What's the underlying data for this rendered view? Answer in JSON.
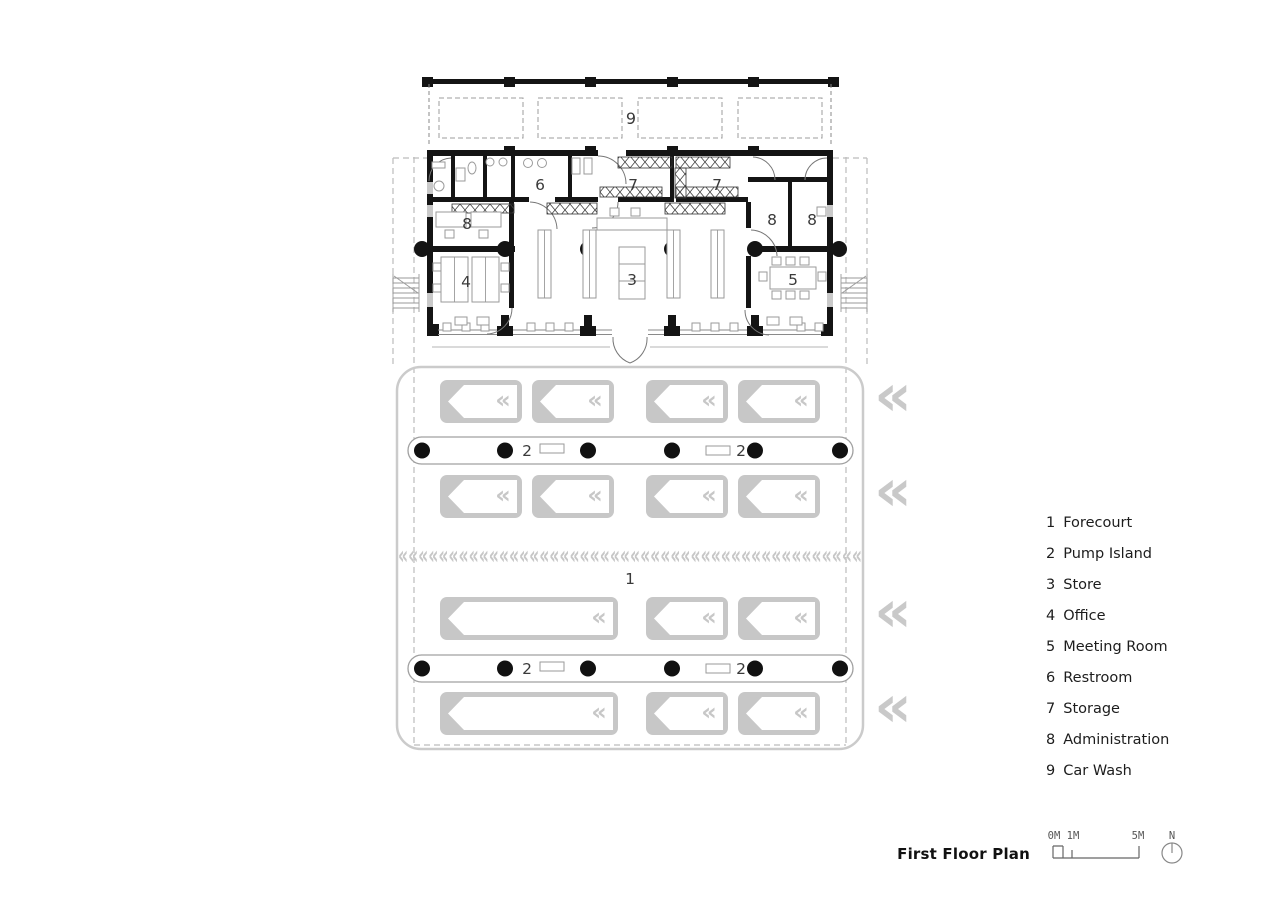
{
  "legend": [
    {
      "num": "1",
      "label": "Forecourt"
    },
    {
      "num": "2",
      "label": "Pump Island"
    },
    {
      "num": "3",
      "label": "Store"
    },
    {
      "num": "4",
      "label": "Office"
    },
    {
      "num": "5",
      "label": "Meeting Room"
    },
    {
      "num": "6",
      "label": "Restroom"
    },
    {
      "num": "7",
      "label": "Storage"
    },
    {
      "num": "8",
      "label": "Administration"
    },
    {
      "num": "9",
      "label": "Car Wash"
    }
  ],
  "titleblock": {
    "title": "First Floor Plan",
    "scale_0": "0M",
    "scale_1": "1M",
    "scale_5": "5M",
    "north": "N"
  },
  "icons": {
    "stall_arrow": "«",
    "entry_arrow": "«",
    "flow_arrow": "«"
  },
  "colors": {
    "wall": "#141414",
    "forecourt_gray": "#c7c7c7",
    "dashed_gray": "#bcbcbc",
    "furniture_gray": "#9a9a9a",
    "label_gray": "#3a3a3a"
  }
}
